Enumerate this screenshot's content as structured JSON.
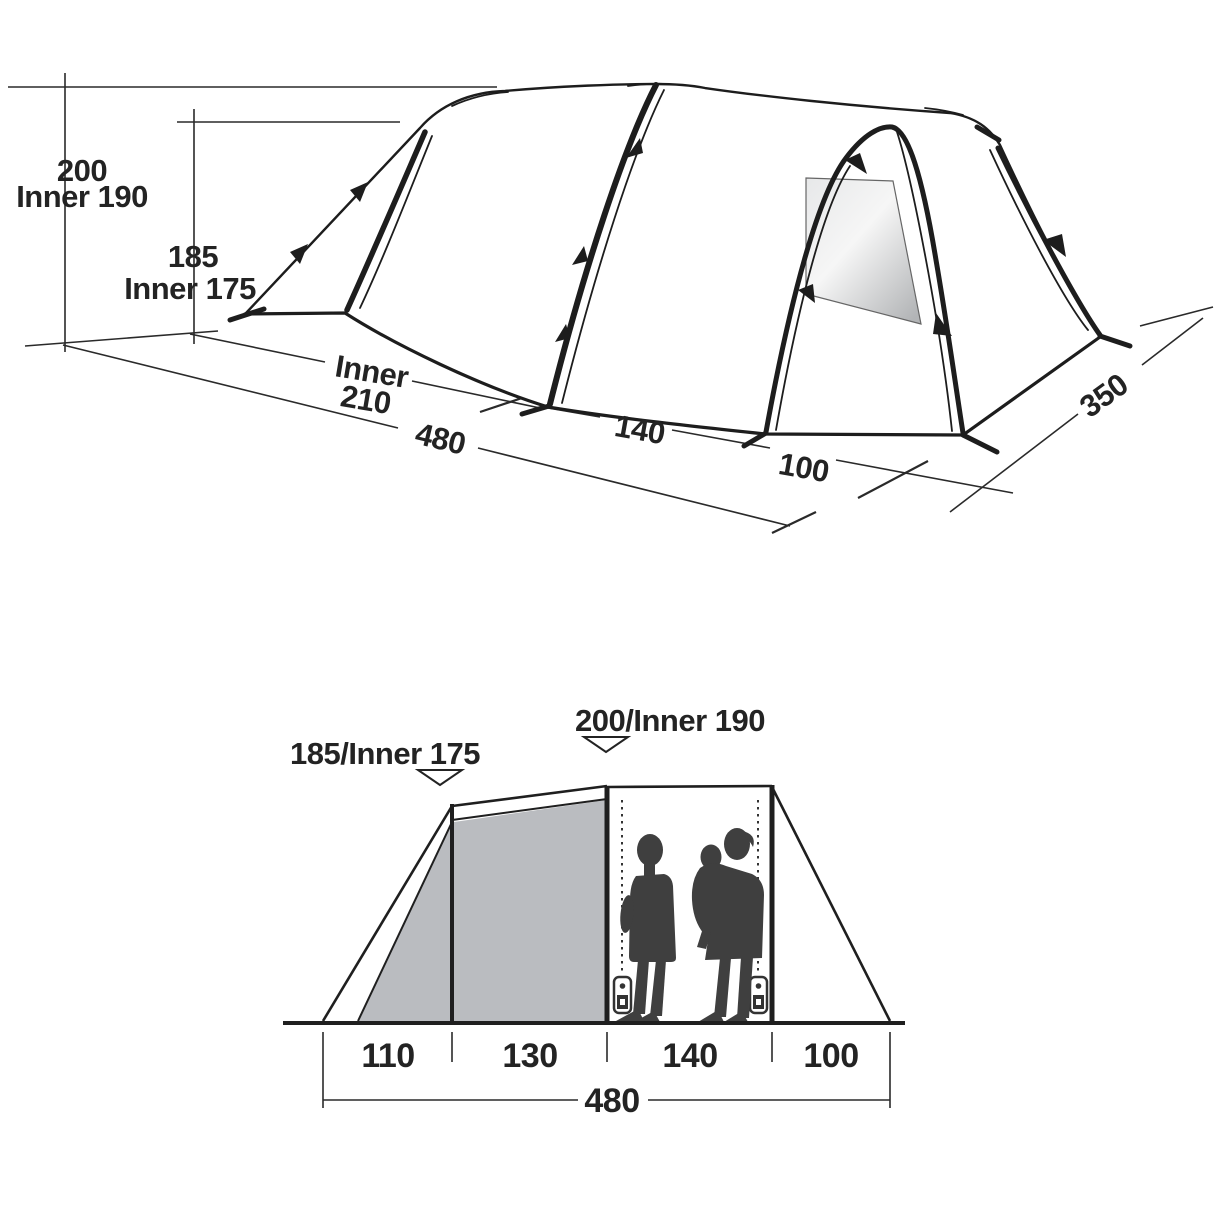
{
  "figure_title": "tent-dimensions-diagram",
  "top_view": {
    "dim_200": "200",
    "dim_inner_190": "Inner 190",
    "dim_185": "185",
    "dim_inner_175": "Inner 175",
    "dim_inner_word": "Inner",
    "dim_210": "210",
    "dim_480": "480",
    "dim_140": "140",
    "dim_100": "100",
    "dim_350": "350"
  },
  "side_view": {
    "label_front_height": "185/Inner 175",
    "label_main_height": "200/Inner 190",
    "seg_110": "110",
    "seg_130": "130",
    "seg_140": "140",
    "seg_100": "100",
    "total_480": "480"
  },
  "colors": {
    "line": "#1d1d1d",
    "panel_gray": "#babcc0",
    "silhouette": "#3f3f3f",
    "window_light": "#f5f6f6",
    "window_dark": "#b2b4b6",
    "background": "#ffffff"
  }
}
